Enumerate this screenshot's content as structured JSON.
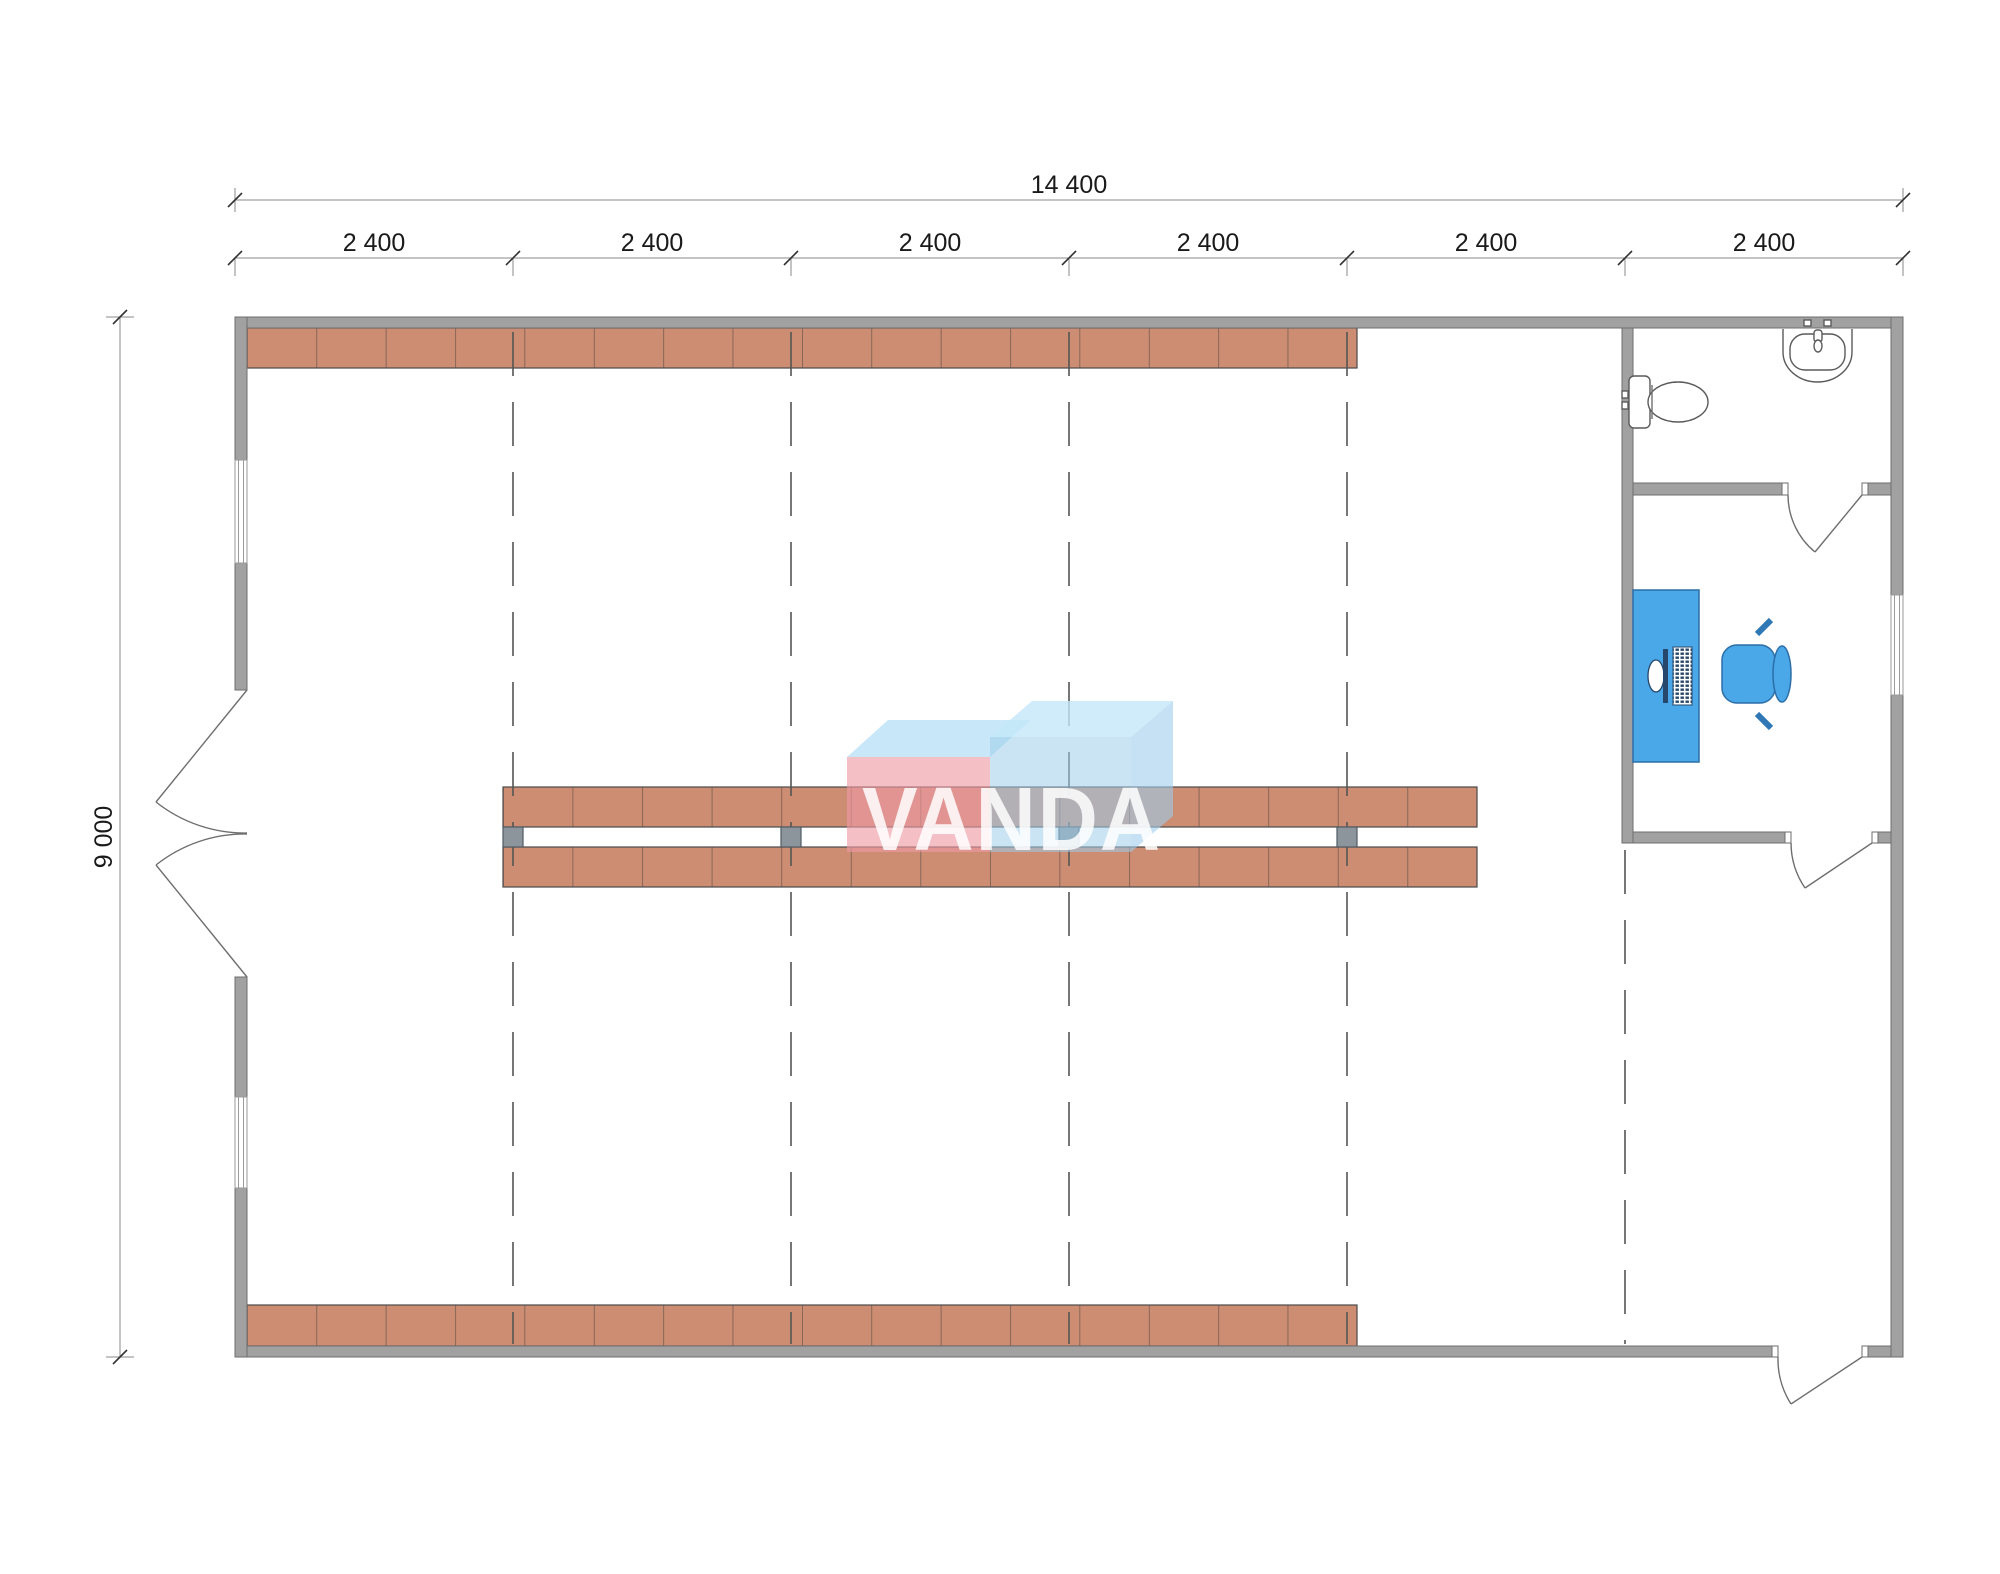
{
  "drawing": {
    "type": "floor-plan",
    "dimensions": {
      "overall_width_label": "14 400",
      "overall_height_label": "9 000",
      "bay_labels": [
        "2 400",
        "2 400",
        "2 400",
        "2 400",
        "2 400",
        "2 400"
      ]
    },
    "watermark": {
      "text": "VANDA",
      "pink_box_color": "#ef9aa6",
      "blue_box_color": "#a8d6f0",
      "top_face_color": "#cfe8f6"
    },
    "colors": {
      "wall": "#a1a1a1",
      "wall_outline": "#6e6e6e",
      "shelving": "#cc8d73",
      "shelving_divider": "#6d564a",
      "post": "#8b959b",
      "grid_dash": "#555555",
      "furniture_blue": "#4aa7e8",
      "furniture_blue_dark": "#2c6ea8",
      "dimension_text": "#1a1a1a"
    },
    "symbols": [
      "toilet-icon",
      "sink-icon",
      "office-desk",
      "office-chair",
      "monitor-icon",
      "keyboard-icon",
      "double-entrance-door",
      "single-doors",
      "shelving-runs"
    ]
  }
}
